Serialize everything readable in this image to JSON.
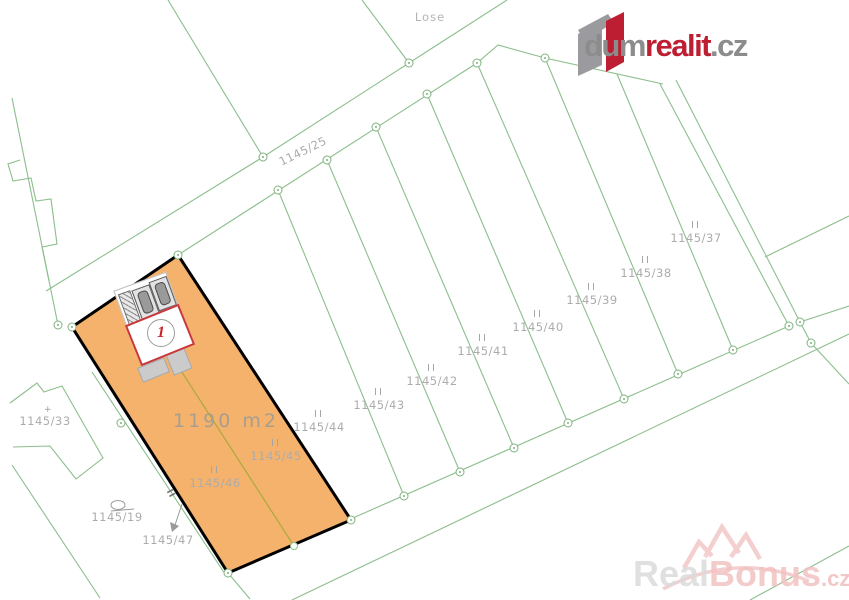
{
  "logo": {
    "part1": "dum",
    "part2": "realit",
    "part3": ".cz"
  },
  "watermark": {
    "part1": "Real",
    "part2": "Bonus",
    "part3": ".cz"
  },
  "map": {
    "street_label": "Lose",
    "road_label": "1145/25",
    "area_label": "1190  m2",
    "marker_number": "1",
    "edge_tick": "II",
    "corner_mark": "+",
    "colors": {
      "parcel_fill": "#F4B26C",
      "parcel_border": "#000000",
      "line_green": "#8CBE8C",
      "divider_olive": "#AAAA3C",
      "label_gray": "#ACACAC",
      "marker_red": "#C8373B",
      "logo_red": "#BE1E32",
      "logo_gray": "#8C8C8C",
      "watermark_pink": "#F2C2C2"
    },
    "parcels": [
      {
        "label": "1145/37",
        "mark": "II",
        "x": 696,
        "y": 233
      },
      {
        "label": "1145/38",
        "mark": "II",
        "x": 646,
        "y": 268
      },
      {
        "label": "1145/39",
        "mark": "II",
        "x": 592,
        "y": 295
      },
      {
        "label": "1145/40",
        "mark": "II",
        "x": 538,
        "y": 322
      },
      {
        "label": "1145/41",
        "mark": "II",
        "x": 483,
        "y": 346
      },
      {
        "label": "1145/42",
        "mark": "II",
        "x": 432,
        "y": 376
      },
      {
        "label": "1145/43",
        "mark": "II",
        "x": 379,
        "y": 400
      },
      {
        "label": "1145/44",
        "mark": "II",
        "x": 319,
        "y": 422
      },
      {
        "label": "1145/45",
        "mark": "II",
        "x": 276,
        "y": 451
      },
      {
        "label": "1145/46",
        "mark": "II",
        "x": 215,
        "y": 478
      },
      {
        "label": "1145/47",
        "mark": "",
        "x": 168,
        "y": 541
      },
      {
        "label": "1145/19",
        "mark": "",
        "x": 117,
        "y": 518
      },
      {
        "label": "1145/33",
        "mark": "",
        "x": 45,
        "y": 422
      }
    ]
  }
}
